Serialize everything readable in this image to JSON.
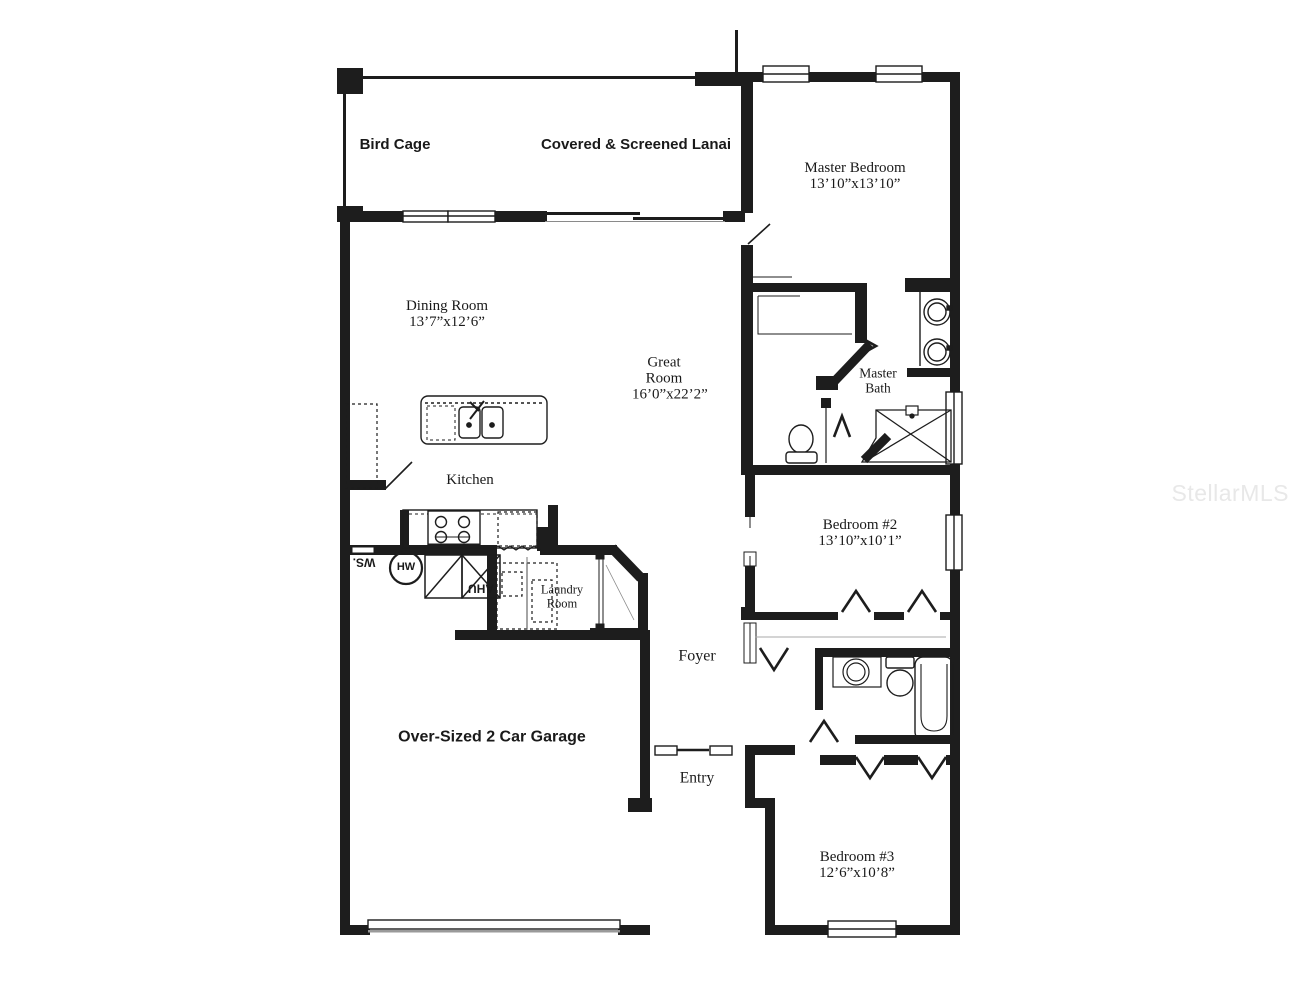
{
  "watermark": "StellarMLS",
  "rooms": [
    {
      "id": "bird-cage",
      "label": "Bird Cage",
      "dims": ""
    },
    {
      "id": "lanai",
      "label": "Covered & Screened Lanai",
      "dims": ""
    },
    {
      "id": "master-bedroom",
      "label": "Master Bedroom",
      "dims": "13’10”x13’10”"
    },
    {
      "id": "dining-room",
      "label": "Dining Room",
      "dims": "13’7”x12’6”"
    },
    {
      "id": "great-room",
      "label": "Great Room",
      "dims": "16’0”x22’2”"
    },
    {
      "id": "kitchen",
      "label": "Kitchen",
      "dims": ""
    },
    {
      "id": "master-bath",
      "label": "Master Bath",
      "dims": ""
    },
    {
      "id": "bedroom-2",
      "label": "Bedroom #2",
      "dims": "13’10”x10’1”"
    },
    {
      "id": "laundry-room",
      "label": "Laundry Room",
      "dims": ""
    },
    {
      "id": "foyer",
      "label": "Foyer",
      "dims": ""
    },
    {
      "id": "garage",
      "label": "Over-Sized 2 Car Garage",
      "dims": ""
    },
    {
      "id": "entry",
      "label": "Entry",
      "dims": ""
    },
    {
      "id": "bedroom-3",
      "label": "Bedroom #3",
      "dims": "12’6”x10’8”"
    }
  ],
  "equipment": {
    "water_heater": "HW",
    "air_handler": "AHU",
    "water_softener": "WS."
  },
  "colors": {
    "wall": "#1d1d1d",
    "watermark": "#e8e8e8"
  }
}
